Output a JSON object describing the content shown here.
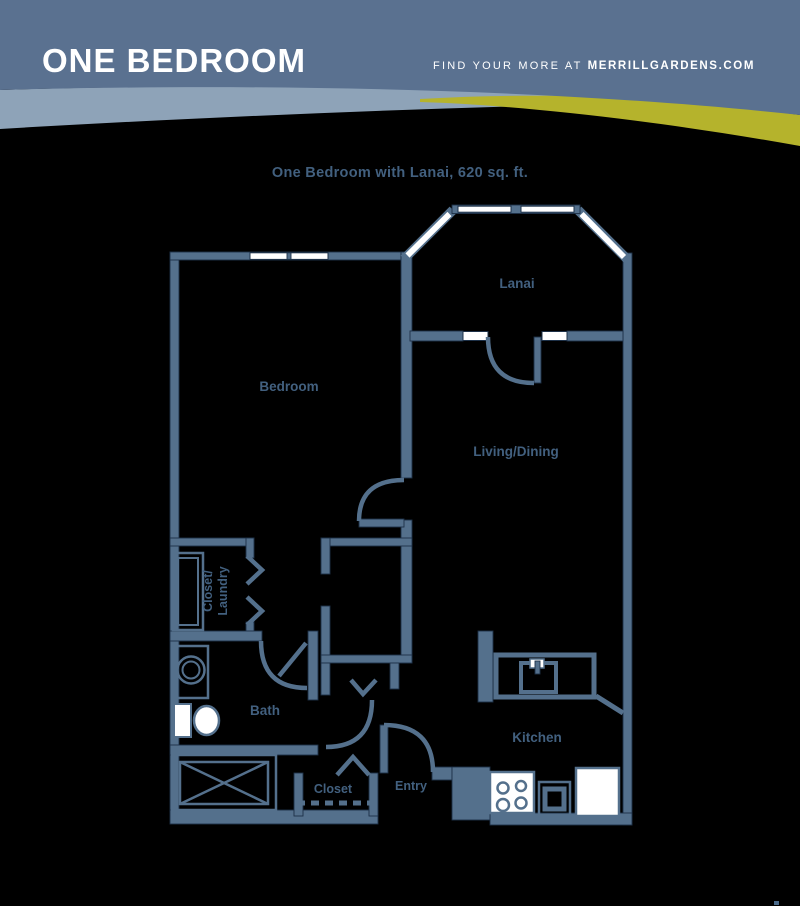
{
  "header": {
    "title": "ONE BEDROOM",
    "tagline_regular": "FIND YOUR MORE AT ",
    "tagline_bold": "MERRILLGARDENS.COM"
  },
  "plan": {
    "title": "One Bedroom with Lanai, 620 sq. ft.",
    "labels": {
      "lanai": "Lanai",
      "bedroom": "Bedroom",
      "living_dining": "Living/Dining",
      "bath": "Bath",
      "kitchen": "Kitchen",
      "entry": "Entry",
      "closet": "Closet",
      "closet_laundry_line1": "Closet/",
      "closet_laundry_line2": "Laundry"
    }
  },
  "colors": {
    "page_bg": "#000000",
    "header_bg": "#5a7190",
    "light_band": "#8ea3b8",
    "accent_yellow": "#b5b32c",
    "wall": "#54708c",
    "wall_dark": "#1d3047",
    "label_text": "#42607f",
    "fixture_white": "#ffffff"
  }
}
